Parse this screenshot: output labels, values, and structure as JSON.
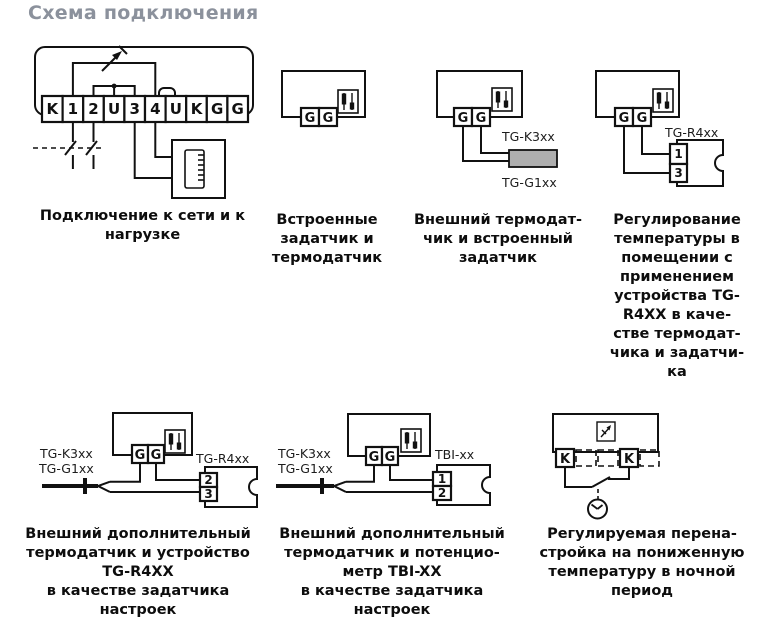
{
  "title": "Схема подключения",
  "icons": {
    "trimmer": "trimmer-icon (two slider potentiometers)",
    "adjust": "adjust-icon (diagonal arrow in square)",
    "clock": "clock-icon",
    "triac": "surge-arrow-icon"
  },
  "diagrams": {
    "d1": {
      "terminals": [
        "K",
        "1",
        "2",
        "U",
        "3",
        "4",
        "U",
        "K",
        "G",
        "G"
      ],
      "caption": "Подключение к сети и к\nнагрузке"
    },
    "d2": {
      "terminals": [
        "G",
        "G"
      ],
      "caption": "Встроенные\nзадатчик  и\nтермодатчик"
    },
    "d3": {
      "terminals": [
        "G",
        "G"
      ],
      "label_top": "TG-K3xx",
      "label_bottom": "TG-G1xx",
      "caption": "Внешний термодат-\nчик и встроенный\nзадатчик"
    },
    "d4": {
      "terminals": [
        "G",
        "G"
      ],
      "device_label": "TG-R4xx",
      "device_terminals": [
        "1",
        "3"
      ],
      "caption": "Регулирование\nтемпературы в\nпомещении с\nприменением\nустройства TG-\nR4XX в каче-\nстве термодат-\nчика и задатчи-\nка"
    },
    "d5": {
      "terminals": [
        "G",
        "G"
      ],
      "label_top": "TG-K3xx",
      "label_bottom": "TG-G1xx",
      "device_label": "TG-R4xx",
      "device_terminals": [
        "2",
        "3"
      ],
      "caption": "Внешний дополнительный\nтермодатчик и устройство\nTG-R4XX\nв качестве задатчика\nнастроек"
    },
    "d6": {
      "terminals": [
        "G",
        "G"
      ],
      "label_top": "TG-K3xx",
      "label_bottom": "TG-G1xx",
      "device_label": "TBI-xx",
      "device_terminals": [
        "1",
        "2"
      ],
      "caption": "Внешний дополнительный\nтермодатчик и потенцио-\nметр TBI-XX\nв качестве задатчика\nнастроек"
    },
    "d7": {
      "terminals": [
        "K",
        "K"
      ],
      "caption": "Регулируемая перена-\nстройка на пониженную\nтемпературу в ночной\nпериод"
    }
  }
}
